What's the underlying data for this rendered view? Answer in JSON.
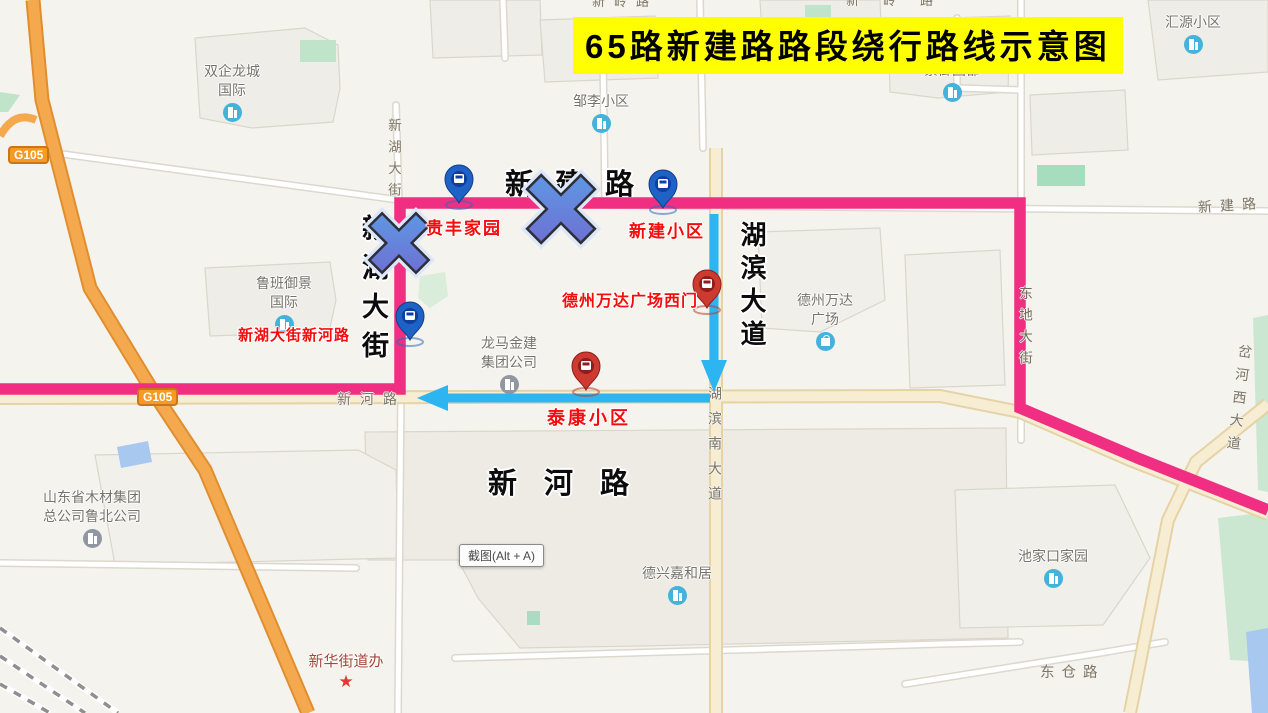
{
  "title": {
    "text": "65路新建路路段绕行路线示意图"
  },
  "screenshot_button": {
    "label": "截图(Alt + A)"
  },
  "colors": {
    "route": "#F02E82",
    "detour_arrow": "#2CB5F0",
    "title_bg": "#FFFF00",
    "title_fg": "#000000",
    "stop_label": "#F50D0D",
    "highway_badge_bg": "#F59A23"
  },
  "annotations": {
    "streets": [
      {
        "text": "新建路"
      },
      {
        "text": "新湖大街"
      },
      {
        "text": "湖滨大道"
      },
      {
        "text": "新河路"
      }
    ],
    "stops": [
      {
        "name": "贵丰家园",
        "pin": "blue"
      },
      {
        "name": "新建小区",
        "pin": "blue"
      },
      {
        "name": "新湖大街新河路",
        "pin": "blue"
      },
      {
        "name": "德州万达广场西门",
        "pin": "red"
      },
      {
        "name": "泰康小区",
        "pin": "red"
      }
    ],
    "closed_marks": [
      {
        "name": "x-mark-xinhu-dajie"
      },
      {
        "name": "x-mark-xinjian-road"
      }
    ]
  },
  "map": {
    "highway_badges": [
      {
        "text": "G105"
      },
      {
        "text": "G105"
      }
    ],
    "road_labels": [
      {
        "text": "新河路"
      },
      {
        "text": "新建路"
      },
      {
        "text": "新湖大街"
      },
      {
        "text": "湖滨南大道"
      },
      {
        "text": "东地大街"
      },
      {
        "text": "岔河西大道"
      },
      {
        "text": "东仓路"
      },
      {
        "text": "新岭路"
      },
      {
        "text": "新岭路"
      }
    ],
    "pois": [
      {
        "line1": "双企龙城",
        "line2": "国际"
      },
      {
        "line1": "汇源小区",
        "line2": ""
      },
      {
        "line1": "紫御国都",
        "line2": ""
      },
      {
        "line1": "邹李小区",
        "line2": ""
      },
      {
        "line1": "鲁班御景",
        "line2": "国际"
      },
      {
        "line1": "龙马金建",
        "line2": "集团公司"
      },
      {
        "line1": "德州万达",
        "line2": "广场"
      },
      {
        "line1": "山东省木材集团",
        "line2": "总公司鲁北公司"
      },
      {
        "line1": "德兴嘉和居",
        "line2": ""
      },
      {
        "line1": "池家口家园",
        "line2": ""
      },
      {
        "line1": "新华街道办",
        "line2": ""
      }
    ]
  }
}
